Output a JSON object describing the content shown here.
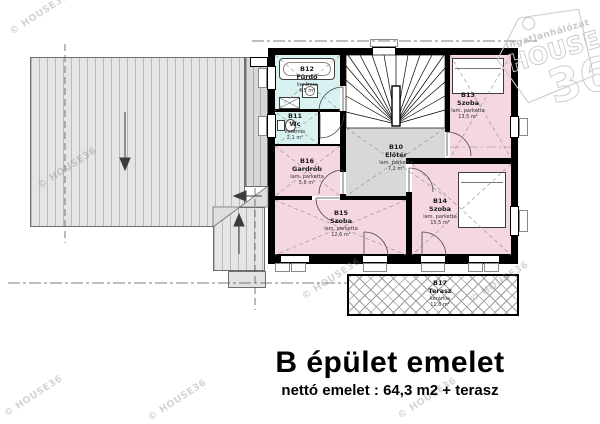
{
  "title": {
    "main": "B épület emelet",
    "subtitle": "nettó emelet : 64,3 m2 + terasz"
  },
  "watermark": {
    "text": "© HOUSE36"
  },
  "logo": {
    "line1": "ingatlanhálózat",
    "line2": "HOUSE",
    "line3": "36"
  },
  "rooms": [
    {
      "id": "B10",
      "name": "Előtér",
      "floor": "lam. parketta",
      "area": "7,2 m²"
    },
    {
      "id": "B11",
      "name": "Wc",
      "floor": "kerámia",
      "area": "2,1 m²"
    },
    {
      "id": "B12",
      "name": "Fürdő",
      "floor": "kerámia",
      "area": "4,5 m²"
    },
    {
      "id": "B13",
      "name": "Szoba",
      "floor": "lam. parketta",
      "area": "13,5 m²"
    },
    {
      "id": "B14",
      "name": "Szoba",
      "floor": "lam. parketta",
      "area": "15,5 m²"
    },
    {
      "id": "B15",
      "name": "Szoba",
      "floor": "lam. parketta",
      "area": "12,6 m²"
    },
    {
      "id": "B16",
      "name": "Gardrób",
      "floor": "lam. parketta",
      "area": "5,6 m²"
    },
    {
      "id": "B17",
      "name": "Terasz",
      "floor": "kerámia",
      "area": "11,6 m²"
    }
  ],
  "colors": {
    "room_pink": "#f5d7e0",
    "wet_room_cyan": "#d9f1f1",
    "hall_gray": "#d8d8d8",
    "roof_gray": "#e5e5e5",
    "wall_black": "#000000",
    "watermark_gray": "#7d7d7d"
  }
}
